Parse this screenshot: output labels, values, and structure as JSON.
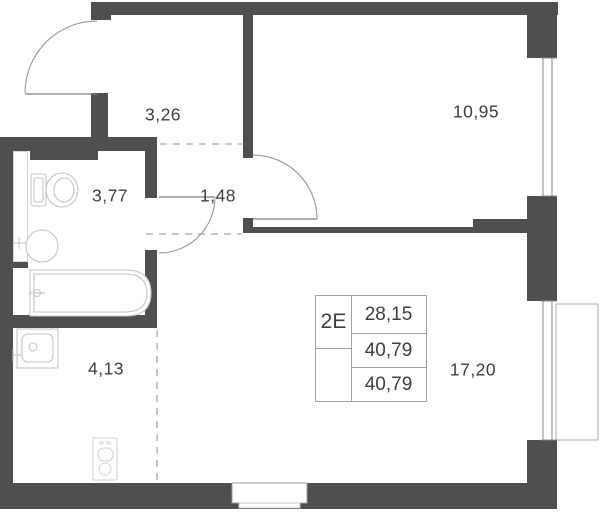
{
  "plan_title": "apartment-floor-plan",
  "rooms": [
    {
      "name": "hallway",
      "area": "3,26"
    },
    {
      "name": "bedroom",
      "area": "10,95"
    },
    {
      "name": "bathroom",
      "area": "3,77"
    },
    {
      "name": "corridor",
      "area": "1,48"
    },
    {
      "name": "kitchen",
      "area": "4,13"
    },
    {
      "name": "living-room",
      "area": "17,20"
    }
  ],
  "info_table": {
    "flat_type": "2Е",
    "rows": [
      "28,15",
      "40,79",
      "40,79"
    ]
  },
  "colors": {
    "wall": "#4f4f4f",
    "fixture_line": "#c4c4c4",
    "door_line": "#8f8f8f",
    "dashed_zone_line": "#a5a5a5",
    "text": "#3e3e3e",
    "table_border": "#a0a0a0",
    "background": "#ffffff"
  }
}
